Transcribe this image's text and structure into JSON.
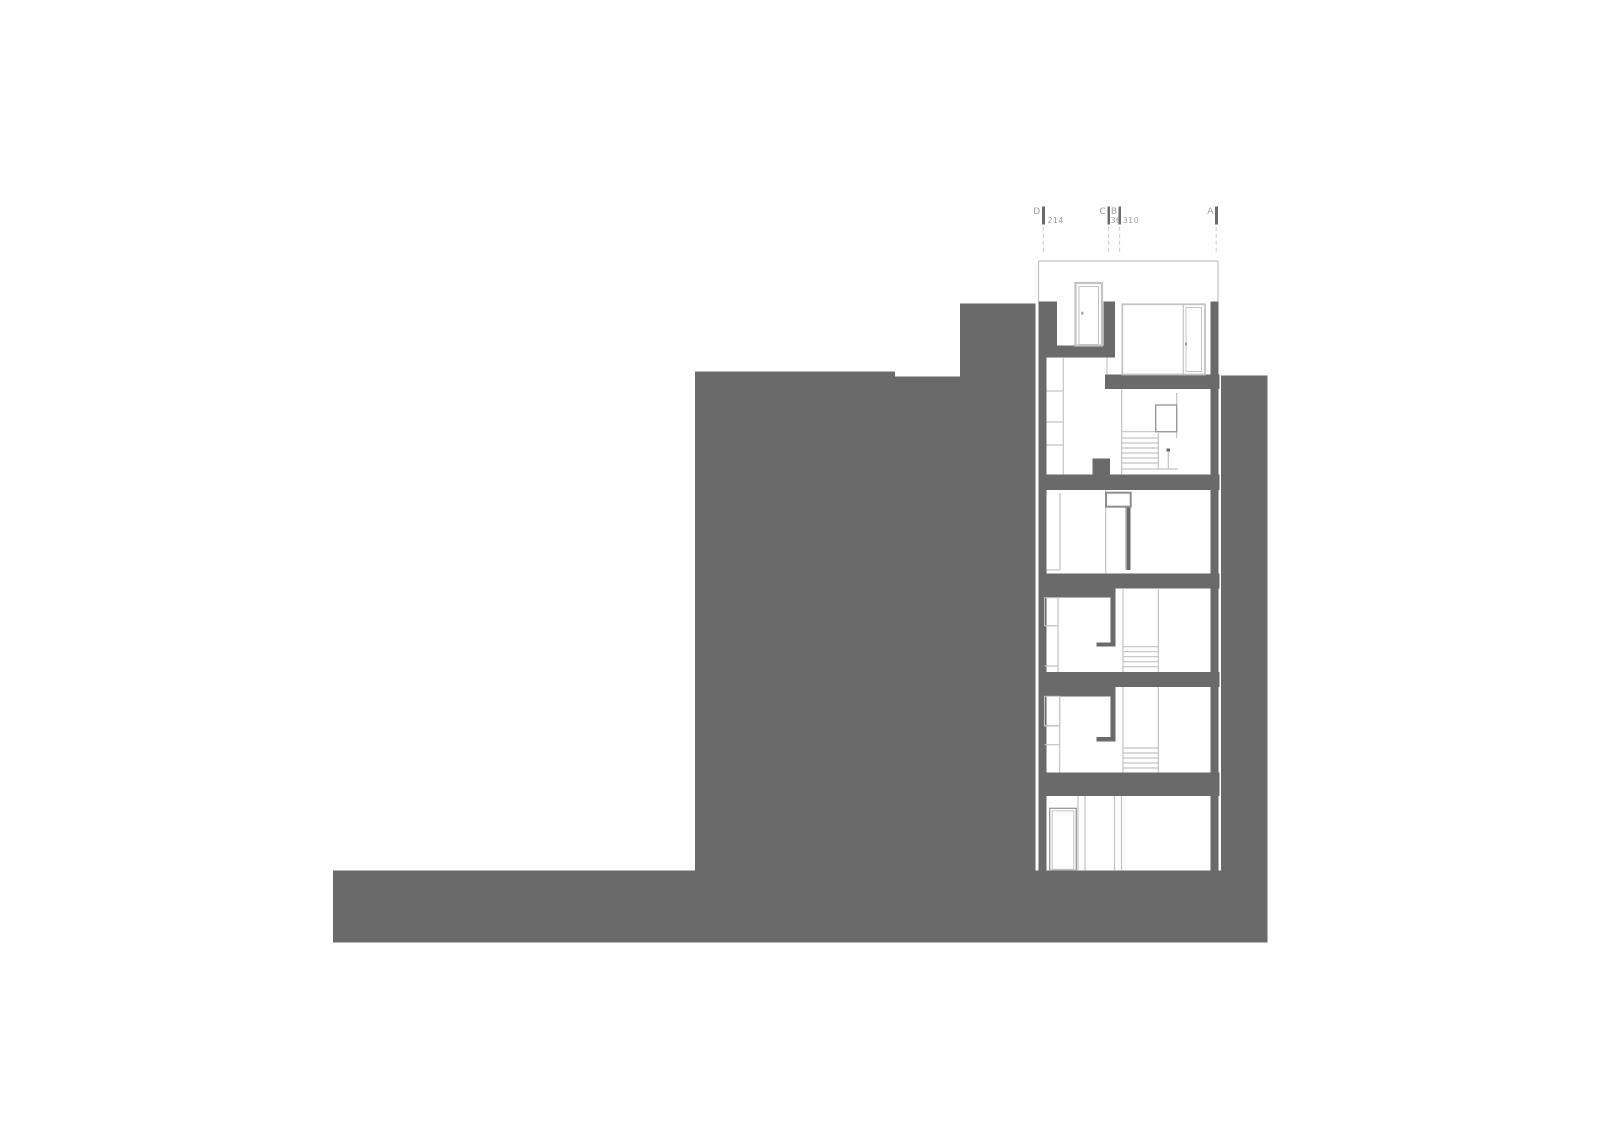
{
  "meta": {
    "width": 1600,
    "height": 1131,
    "background": "#ffffff",
    "drawing_type": "building-section"
  },
  "colors": {
    "poche": "#6a6a6a",
    "line_light": "#c3c3c3",
    "line_mid": "#9a9a9a",
    "line_strong": "#8d8d8d",
    "dash": "#cfcfcf",
    "text": "#9e9e9e",
    "background": "#ffffff"
  },
  "grid": {
    "letter_baseline_y": 213.8,
    "dim_baseline_y": 222.8,
    "letter_font_size": 9,
    "dim_font_size": 8,
    "tick_y": 206.7,
    "tick_w": 2.8,
    "tick_h": 17.6,
    "dash_y1": 226.7,
    "dash_y2": 252,
    "items": [
      {
        "letter": "D",
        "letter_x": 1040.5,
        "tick_x": 1042.0,
        "dim": "214",
        "dim_x": 1047.5,
        "dash_x": 1043.3
      },
      {
        "letter": "C",
        "letter_x": 1106.0,
        "tick_x": 1107.3,
        "dim": "36",
        "dim_x": 1110.5,
        "dash_x": 1108.6
      },
      {
        "letter": "B",
        "letter_x": 1117.3,
        "tick_x": 1118.3,
        "dim": "310",
        "dim_x": 1122.8,
        "dash_x": 1119.6
      },
      {
        "letter": "A",
        "letter_x": 1213.7,
        "tick_x": 1215.0,
        "dim": "",
        "dim_x": 1219.0,
        "dash_x": 1216.2
      }
    ]
  },
  "drawing": {
    "poche": [
      {
        "name": "ground-base-strip",
        "x": 333.0,
        "y": 870.7,
        "w": 934.3,
        "h": 72.0
      },
      {
        "name": "hill-mass-left",
        "x": 695.0,
        "y": 371.7,
        "w": 200.0,
        "h": 499.0
      },
      {
        "name": "hill-mass-mid",
        "x": 895.0,
        "y": 376.7,
        "w": 65.0,
        "h": 494.0
      },
      {
        "name": "hill-mass-column",
        "x": 960.0,
        "y": 303.3,
        "w": 75.3,
        "h": 567.4
      },
      {
        "name": "neighbor-mass-right",
        "x": 1221.0,
        "y": 375.7,
        "w": 46.3,
        "h": 495.0
      },
      {
        "name": "section-wall-left",
        "x": 1038.5,
        "y": 303.3,
        "w": 8.0,
        "h": 567.4
      },
      {
        "name": "section-wall-right",
        "x": 1210.3,
        "y": 301.7,
        "w": 8.0,
        "h": 569.0
      },
      {
        "name": "attic-wall-left-jamb",
        "x": 1038.5,
        "y": 301.3,
        "w": 18.5,
        "h": 44.4
      },
      {
        "name": "attic-wall-mid-jamb",
        "x": 1103.3,
        "y": 301.3,
        "w": 11.7,
        "h": 55.4
      },
      {
        "name": "slab-roof-left",
        "x": 1038.5,
        "y": 345.3,
        "w": 76.5,
        "h": 12.0
      },
      {
        "name": "slab-roof-right",
        "x": 1105.0,
        "y": 374.5,
        "w": 114.3,
        "h": 14.5
      },
      {
        "name": "slab-level5",
        "x": 1038.5,
        "y": 474.3,
        "w": 180.8,
        "h": 15.7
      },
      {
        "name": "slab-level4",
        "x": 1038.5,
        "y": 573.3,
        "w": 180.8,
        "h": 15.0
      },
      {
        "name": "slab-level4-left-ext",
        "x": 1038.5,
        "y": 588.3,
        "w": 72.2,
        "h": 9.4
      },
      {
        "name": "slab-level3",
        "x": 1038.5,
        "y": 672.0,
        "w": 180.8,
        "h": 15.0
      },
      {
        "name": "slab-level3-left-ext",
        "x": 1038.5,
        "y": 687.0,
        "w": 72.2,
        "h": 9.3
      },
      {
        "name": "slab-level2-thick",
        "x": 1038.5,
        "y": 772.3,
        "w": 180.8,
        "h": 23.7
      },
      {
        "name": "parapet-stub-level5",
        "x": 1092.3,
        "y": 458.3,
        "w": 17.7,
        "h": 16.0
      },
      {
        "name": "hung-wall-level3",
        "x": 1110.7,
        "y": 585.0,
        "w": 5.0,
        "h": 60.5
      },
      {
        "name": "hung-wall-foot-level3",
        "x": 1096.3,
        "y": 642.3,
        "w": 19.4,
        "h": 4.4
      },
      {
        "name": "hung-wall-level2",
        "x": 1110.7,
        "y": 683.0,
        "w": 5.0,
        "h": 58.4
      },
      {
        "name": "hung-wall-foot-level2",
        "x": 1096.3,
        "y": 737.0,
        "w": 19.4,
        "h": 4.3
      },
      {
        "name": "door-jamb-level4",
        "x": 1126.7,
        "y": 506.7,
        "w": 4.0,
        "h": 63.3
      },
      {
        "name": "newel-post-level5",
        "x": 1166.7,
        "y": 448.3,
        "w": 3.3,
        "h": 3.4
      }
    ],
    "lines": [
      {
        "name": "roof-outline-top",
        "x1": 1038.5,
        "y1": 261.0,
        "x2": 1218.0,
        "y2": 261.0
      },
      {
        "name": "roof-outline-left",
        "x1": 1038.5,
        "y1": 261.0,
        "x2": 1038.5,
        "y2": 301.3
      },
      {
        "name": "roof-outline-right",
        "x1": 1218.0,
        "y1": 261.0,
        "x2": 1218.0,
        "y2": 301.7
      },
      {
        "name": "roof-step-line",
        "x1": 1107.0,
        "y1": 357.3,
        "x2": 1107.0,
        "y2": 374.5
      },
      {
        "name": "glass-mullion-attic",
        "x1": 1183.3,
        "y1": 304.3,
        "x2": 1183.3,
        "y2": 374.5
      },
      {
        "name": "wardrobe-level5",
        "x1": 1063.3,
        "y1": 357.3,
        "x2": 1063.3,
        "y2": 474.3
      },
      {
        "name": "shelf-level5",
        "x1": 1046.5,
        "y1": 391.0,
        "x2": 1063.3,
        "y2": 391.0
      },
      {
        "name": "shelf-level5",
        "x1": 1046.5,
        "y1": 422.0,
        "x2": 1063.3,
        "y2": 422.0
      },
      {
        "name": "shelf-level5",
        "x1": 1046.5,
        "y1": 445.0,
        "x2": 1063.3,
        "y2": 445.0
      },
      {
        "name": "stairwell-wall-level5",
        "x1": 1121.7,
        "y1": 389.0,
        "x2": 1121.7,
        "y2": 474.3
      },
      {
        "name": "closet-side-level5",
        "x1": 1176.7,
        "y1": 393.0,
        "x2": 1176.7,
        "y2": 438.0
      },
      {
        "name": "landing-line-level5",
        "x1": 1121.7,
        "y1": 431.7,
        "x2": 1176.7,
        "y2": 431.7
      },
      {
        "name": "stair-tread-level5",
        "x1": 1122.0,
        "y1": 438.0,
        "x2": 1158.3,
        "y2": 438.0
      },
      {
        "name": "stair-tread-level5",
        "x1": 1122.0,
        "y1": 443.0,
        "x2": 1158.3,
        "y2": 443.0
      },
      {
        "name": "stair-tread-level5",
        "x1": 1122.0,
        "y1": 448.0,
        "x2": 1158.3,
        "y2": 448.0
      },
      {
        "name": "stair-tread-level5",
        "x1": 1122.0,
        "y1": 453.0,
        "x2": 1158.3,
        "y2": 453.0
      },
      {
        "name": "stair-tread-level5",
        "x1": 1122.0,
        "y1": 458.0,
        "x2": 1158.3,
        "y2": 458.0
      },
      {
        "name": "stair-tread-level5",
        "x1": 1122.0,
        "y1": 463.0,
        "x2": 1158.3,
        "y2": 463.0
      },
      {
        "name": "stair-edge-level5",
        "x1": 1158.3,
        "y1": 433.0,
        "x2": 1158.3,
        "y2": 469.0
      },
      {
        "name": "newel-rod-level5",
        "x1": 1168.3,
        "y1": 451.7,
        "x2": 1168.3,
        "y2": 469.0
      },
      {
        "name": "floor-line-level5",
        "x1": 1121.7,
        "y1": 469.0,
        "x2": 1178.0,
        "y2": 469.0
      },
      {
        "name": "partition-level4",
        "x1": 1105.7,
        "y1": 490.0,
        "x2": 1105.7,
        "y2": 573.3
      },
      {
        "name": "door-leaf-level4",
        "x1": 1125.7,
        "y1": 506.7,
        "x2": 1125.7,
        "y2": 570.0
      },
      {
        "name": "wardrobe-level4",
        "x1": 1060.0,
        "y1": 493.0,
        "x2": 1060.0,
        "y2": 570.0
      },
      {
        "name": "wardrobe-bottom-level4",
        "x1": 1046.5,
        "y1": 570.0,
        "x2": 1060.0,
        "y2": 570.0
      },
      {
        "name": "wardrobe-level3",
        "x1": 1058.0,
        "y1": 597.7,
        "x2": 1058.0,
        "y2": 672.0
      },
      {
        "name": "shelf-level3",
        "x1": 1044.5,
        "y1": 625.7,
        "x2": 1058.0,
        "y2": 625.7
      },
      {
        "name": "shelf-level3",
        "x1": 1044.5,
        "y1": 666.0,
        "x2": 1058.0,
        "y2": 666.0
      },
      {
        "name": "stairwell-wall-left-level3",
        "x1": 1123.0,
        "y1": 588.0,
        "x2": 1123.0,
        "y2": 672.0
      },
      {
        "name": "stairwell-wall-right-level3",
        "x1": 1158.3,
        "y1": 588.0,
        "x2": 1158.3,
        "y2": 672.0
      },
      {
        "name": "stair-tread-level3",
        "x1": 1123.0,
        "y1": 646.7,
        "x2": 1158.3,
        "y2": 646.7
      },
      {
        "name": "stair-tread-level3",
        "x1": 1123.0,
        "y1": 651.7,
        "x2": 1158.3,
        "y2": 651.7
      },
      {
        "name": "stair-tread-level3",
        "x1": 1123.0,
        "y1": 656.7,
        "x2": 1158.3,
        "y2": 656.7
      },
      {
        "name": "stair-tread-level3",
        "x1": 1123.0,
        "y1": 661.7,
        "x2": 1158.3,
        "y2": 661.7
      },
      {
        "name": "stair-tread-level3",
        "x1": 1123.0,
        "y1": 666.7,
        "x2": 1158.3,
        "y2": 666.7
      },
      {
        "name": "wardrobe-level2",
        "x1": 1059.7,
        "y1": 696.3,
        "x2": 1059.7,
        "y2": 772.3
      },
      {
        "name": "shelf-level2",
        "x1": 1044.5,
        "y1": 725.5,
        "x2": 1059.7,
        "y2": 725.5
      },
      {
        "name": "shelf-level2",
        "x1": 1044.5,
        "y1": 744.7,
        "x2": 1059.7,
        "y2": 744.7
      },
      {
        "name": "stairwell-wall-left-level2",
        "x1": 1123.0,
        "y1": 687.0,
        "x2": 1123.0,
        "y2": 772.3
      },
      {
        "name": "stairwell-wall-right-level2",
        "x1": 1158.3,
        "y1": 687.0,
        "x2": 1158.3,
        "y2": 772.3
      },
      {
        "name": "stair-tread-level2",
        "x1": 1123.0,
        "y1": 748.0,
        "x2": 1158.3,
        "y2": 748.0
      },
      {
        "name": "stair-tread-level2",
        "x1": 1123.0,
        "y1": 753.0,
        "x2": 1158.3,
        "y2": 753.0
      },
      {
        "name": "stair-tread-level2",
        "x1": 1123.0,
        "y1": 758.0,
        "x2": 1158.3,
        "y2": 758.0
      },
      {
        "name": "stair-tread-level2",
        "x1": 1123.0,
        "y1": 763.0,
        "x2": 1158.3,
        "y2": 763.0
      },
      {
        "name": "stair-tread-level2",
        "x1": 1123.0,
        "y1": 768.0,
        "x2": 1158.3,
        "y2": 768.0
      },
      {
        "name": "wall-edge-ground",
        "x1": 1078.0,
        "y1": 796.0,
        "x2": 1078.0,
        "y2": 870.7
      },
      {
        "name": "wall-edge-ground",
        "x1": 1085.0,
        "y1": 796.0,
        "x2": 1085.0,
        "y2": 870.7
      },
      {
        "name": "wall-edge-ground",
        "x1": 1114.5,
        "y1": 796.0,
        "x2": 1114.5,
        "y2": 870.7
      },
      {
        "name": "wall-edge-ground",
        "x1": 1121.5,
        "y1": 796.0,
        "x2": 1121.5,
        "y2": 870.7
      }
    ],
    "outlines": [
      {
        "name": "door-attic",
        "x": 1075.5,
        "y": 283.0,
        "w": 26.5,
        "h": 62.5,
        "c": "line_light",
        "sw": 2.2
      },
      {
        "name": "door-attic-leaf",
        "x": 1079.0,
        "y": 286.5,
        "w": 19.5,
        "h": 58.0,
        "c": "line_light",
        "sw": 1.0
      },
      {
        "name": "glass-unit-attic",
        "x": 1122.3,
        "y": 304.3,
        "w": 82.7,
        "h": 70.2,
        "c": "line_light",
        "sw": 1.8
      },
      {
        "name": "glass-door-panel",
        "x": 1186.0,
        "y": 307.5,
        "w": 15.5,
        "h": 64.0,
        "c": "line_light",
        "sw": 1.0
      },
      {
        "name": "closet-level5",
        "x": 1155.7,
        "y": 405.0,
        "w": 21.0,
        "h": 26.7,
        "c": "line_mid",
        "sw": 1.4
      },
      {
        "name": "cabinet-level4",
        "x": 1106.0,
        "y": 492.7,
        "w": 24.7,
        "h": 14.0,
        "c": "line_strong",
        "sw": 2.0
      },
      {
        "name": "closet-level3",
        "x": 1044.5,
        "y": 597.7,
        "w": 13.5,
        "h": 28.0,
        "c": "line_light",
        "sw": 1.0
      },
      {
        "name": "closet-level2",
        "x": 1044.5,
        "y": 696.3,
        "w": 15.2,
        "h": 29.7,
        "c": "line_light",
        "sw": 1.0
      },
      {
        "name": "door-ground",
        "x": 1049.7,
        "y": 808.3,
        "w": 26.6,
        "h": 62.0,
        "c": "line_mid",
        "sw": 1.3
      },
      {
        "name": "door-ground-leaf",
        "x": 1052.2,
        "y": 810.8,
        "w": 21.6,
        "h": 58.5,
        "c": "line_light",
        "sw": 1.0
      }
    ],
    "marks": [
      {
        "name": "door-handle-mark-attic",
        "x": 1081.3,
        "y": 311.7,
        "w": 2.0,
        "h": 3.0
      },
      {
        "name": "door-handle-mark-glass",
        "x": 1185.0,
        "y": 342.7,
        "w": 2.0,
        "h": 2.7
      }
    ]
  }
}
